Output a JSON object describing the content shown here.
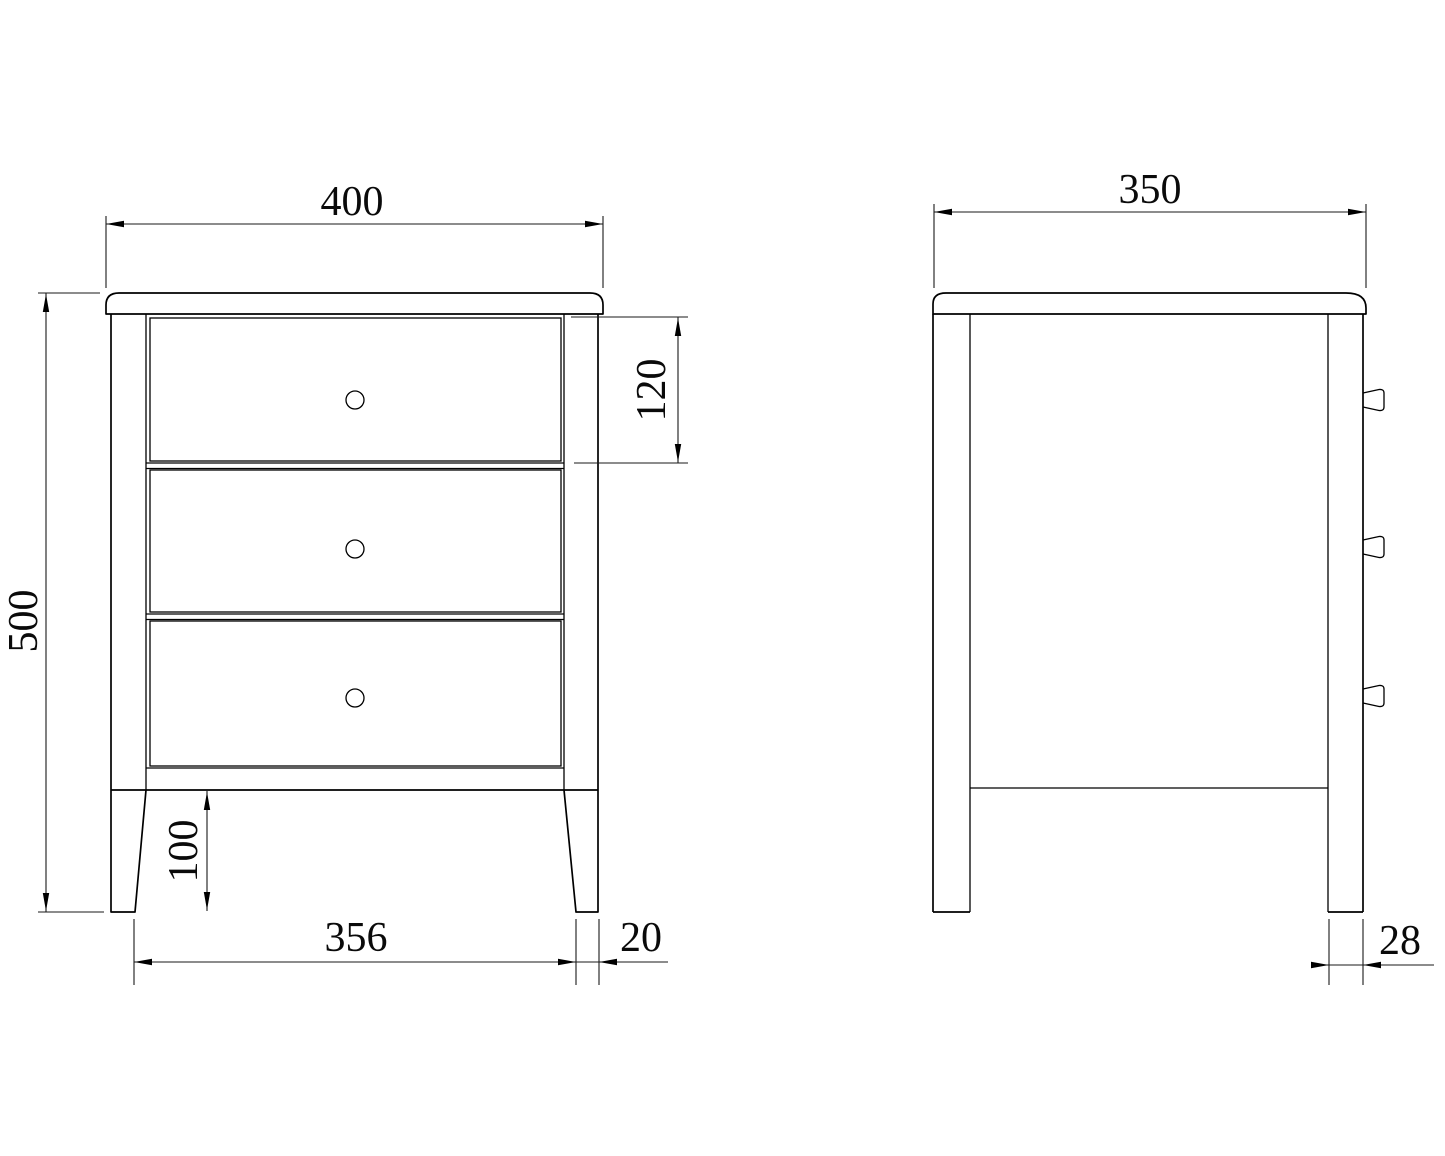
{
  "front_view": {
    "top_width_label": "400",
    "height_label": "500",
    "drawer_height_label": "120",
    "leg_height_label": "100",
    "leg_span_label": "356",
    "leg_width_label": "20",
    "drawer_count": 3
  },
  "side_view": {
    "top_depth_label": "350",
    "leg_depth_label": "28",
    "knob_count": 3
  },
  "style": {
    "line_color": "#000000",
    "background": "#ffffff"
  }
}
